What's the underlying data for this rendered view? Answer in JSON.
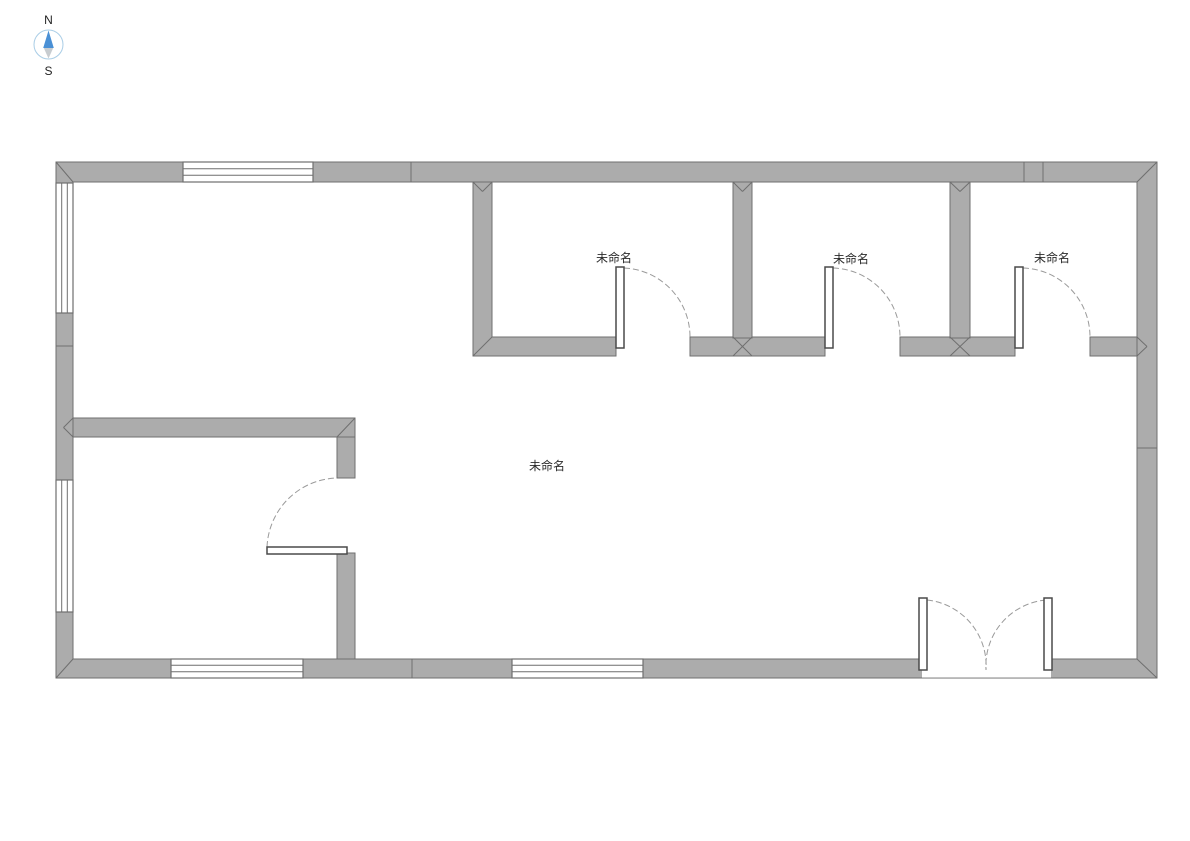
{
  "compass": {
    "north": "N",
    "south": "S"
  },
  "rooms": {
    "top_room_1": {
      "label": "未命名"
    },
    "top_room_2": {
      "label": "未命名"
    },
    "top_room_3": {
      "label": "未命名"
    },
    "main_hall": {
      "label": "未命名"
    }
  },
  "elements": {
    "windows": [
      "top-wall-window",
      "left-wall-window-upper",
      "left-wall-window-lower",
      "bottom-wall-window-left",
      "bottom-wall-window-middle"
    ],
    "doors": [
      "top-room-1-door",
      "top-room-2-door",
      "top-room-3-door",
      "lower-left-room-door",
      "main-entrance-double-door"
    ]
  },
  "colors": {
    "background": "#ffffff",
    "wall_fill": "#acacac",
    "wall_stroke": "#6f6f6f",
    "window_fill": "#ffffff",
    "door_leaf_stroke": "#4a4a4a",
    "door_arc": "#9a9a9a",
    "label_text": "#2a2a2a",
    "compass_north_arrow": "#4a90d5",
    "compass_south_arrow": "#c7ccd0",
    "compass_ring": "#a9cde6"
  }
}
